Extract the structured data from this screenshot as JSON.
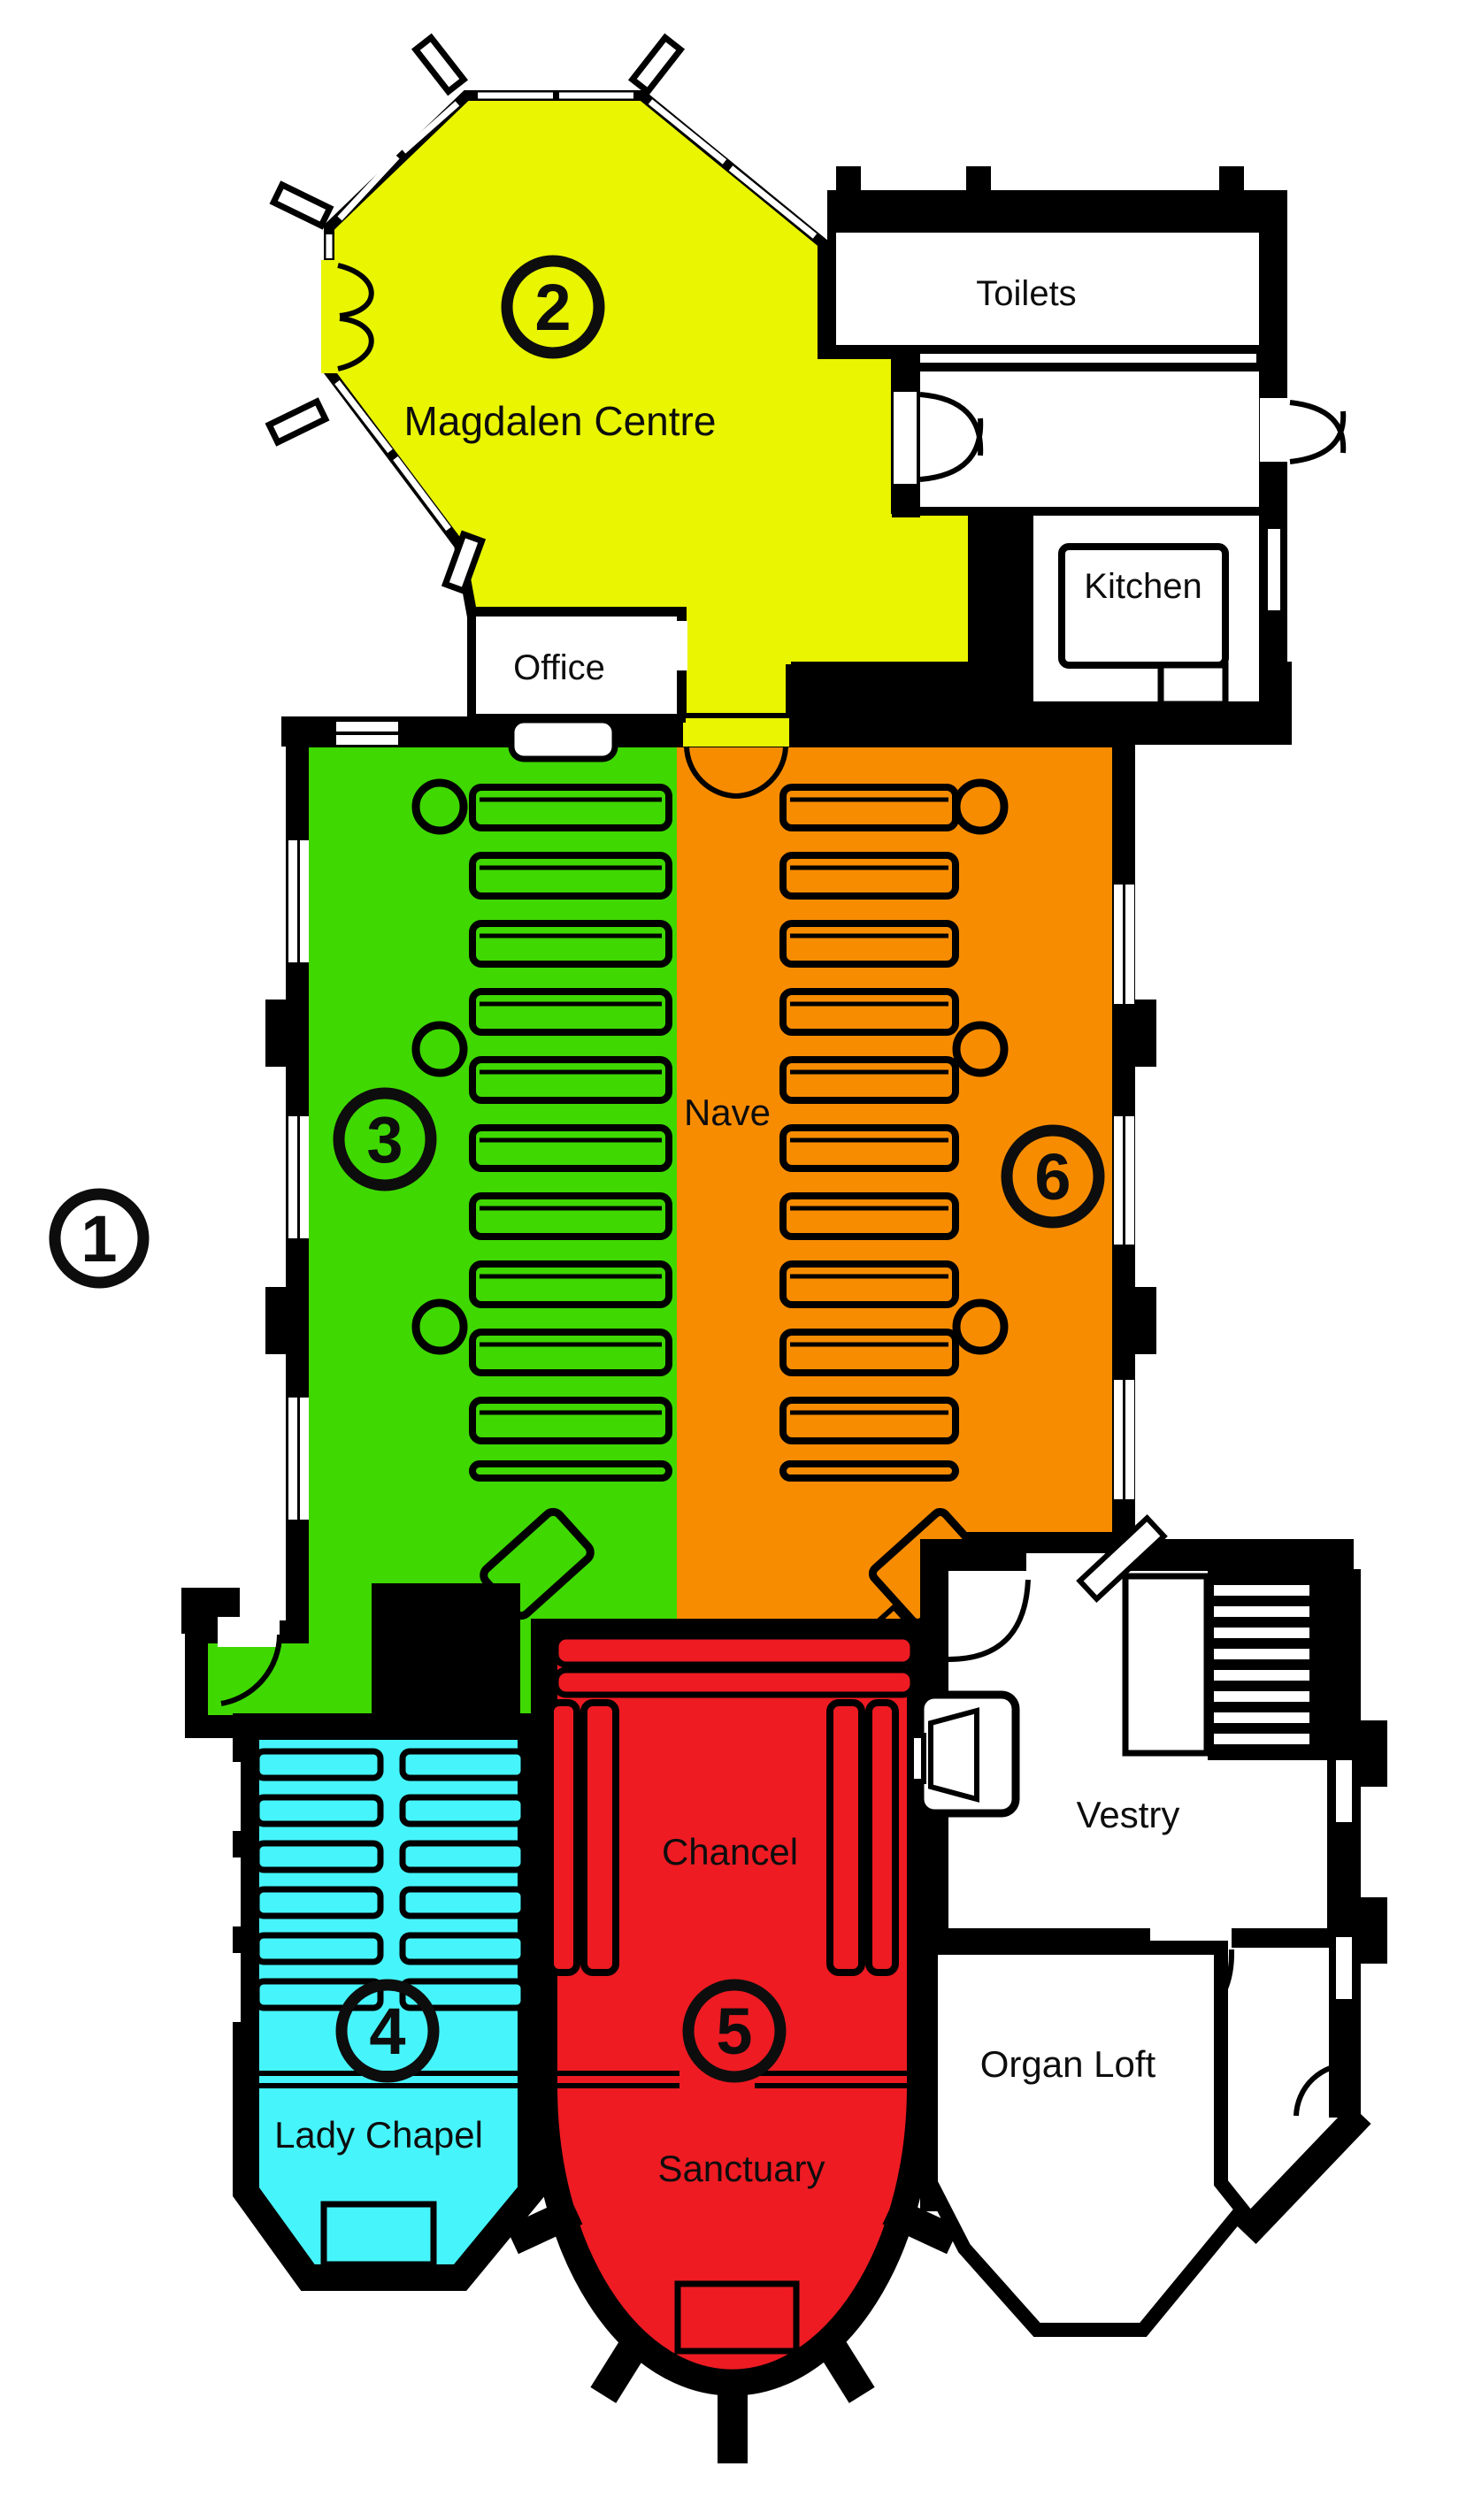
{
  "colors": {
    "magdalen_centre": "#e9f501",
    "nave_north": "#3fd800",
    "nave_south": "#f88c00",
    "lady_chapel": "#46f5fb",
    "chancel": "#ee1b23",
    "walls": "#000000",
    "background": "#ffffff"
  },
  "labels": {
    "magdalen_centre": "Magdalen Centre",
    "office": "Office",
    "toilets": "Toilets",
    "kitchen": "Kitchen",
    "nave": "Nave",
    "chancel": "Chancel",
    "sanctuary": "Sanctuary",
    "lady_chapel": "Lady Chapel",
    "vestry": "Vestry",
    "organ_loft": "Organ Loft"
  },
  "zone_numbers": {
    "outside": "1",
    "magdalen_centre": "2",
    "nave_north": "3",
    "lady_chapel": "4",
    "chancel": "5",
    "nave_south": "6"
  }
}
